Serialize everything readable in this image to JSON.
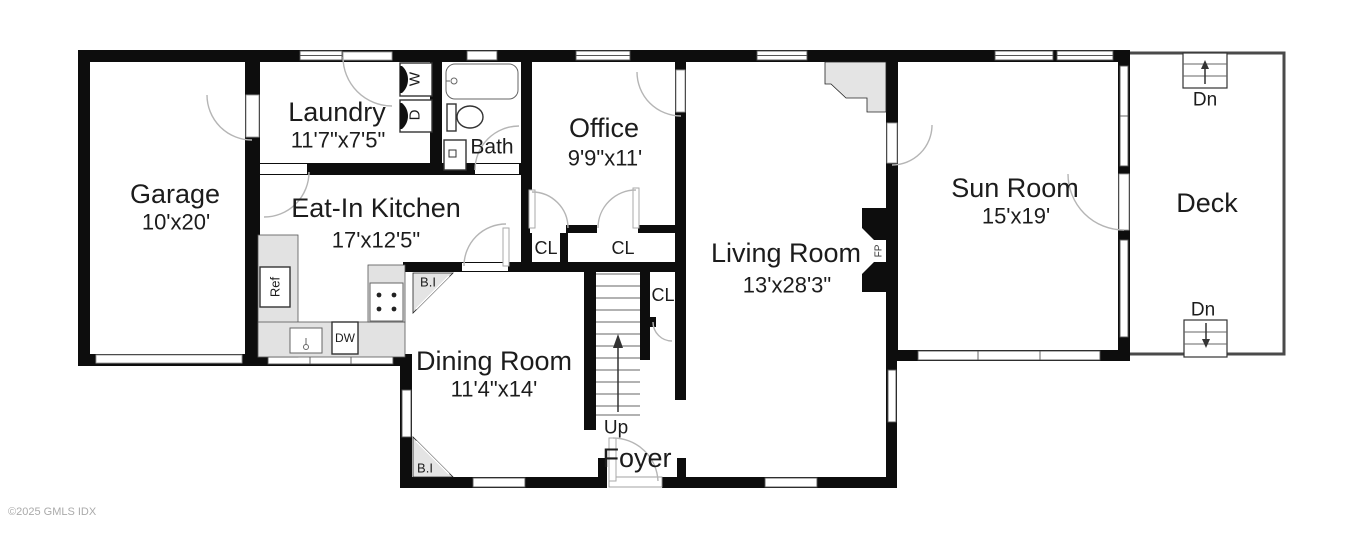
{
  "watermark": "©2025 GMLS IDX",
  "rooms": {
    "garage": {
      "name": "Garage",
      "dims": "10'x20'"
    },
    "laundry": {
      "name": "Laundry",
      "dims": "11'7\"x7'5\""
    },
    "bath": {
      "name": "Bath"
    },
    "office": {
      "name": "Office",
      "dims": "9'9\"x11'"
    },
    "kitchen": {
      "name": "Eat-In Kitchen",
      "dims": "17'x12'5\""
    },
    "living": {
      "name": "Living Room",
      "dims": "13'x28'3\""
    },
    "sunroom": {
      "name": "Sun Room",
      "dims": "15'x19'"
    },
    "deck": {
      "name": "Deck"
    },
    "dining": {
      "name": "Dining Room",
      "dims": "11'4\"x14'"
    },
    "foyer": {
      "name": "Foyer"
    }
  },
  "labels": {
    "closet": "CL",
    "built_in": "B.I",
    "up": "Up",
    "down": "Dn",
    "washer": "W",
    "dryer": "D",
    "dishwasher": "DW",
    "refrigerator": "Ref",
    "fireplace": "FP"
  },
  "colors": {
    "wall": "#0d0d0d",
    "counter": "#e2e2e2",
    "deck_outline": "#4a4a4a"
  }
}
